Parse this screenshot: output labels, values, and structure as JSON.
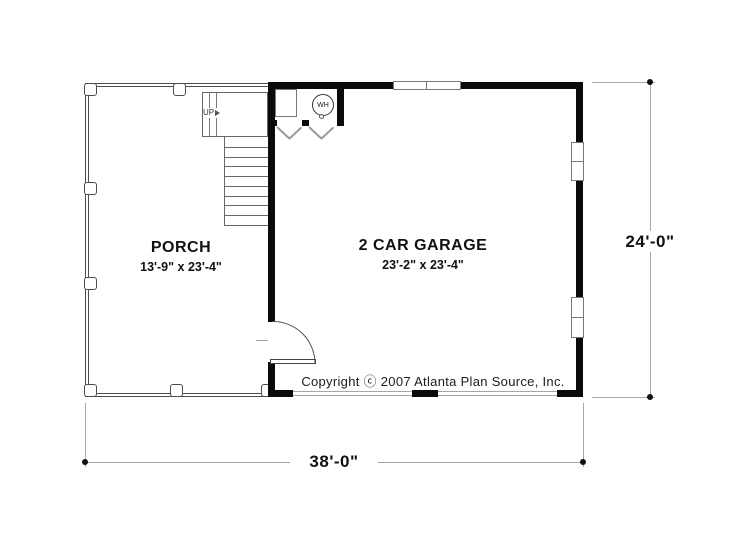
{
  "rooms": [
    {
      "name": "PORCH",
      "size": "13'-9\" x 23'-4\""
    },
    {
      "name": "2 CAR GARAGE",
      "size": "23'-2\" x 23'-4\""
    }
  ],
  "stairs": {
    "up_label": "UP"
  },
  "water_heater": {
    "label": "WH"
  },
  "dimensions": {
    "overall_width": "38'-0\"",
    "overall_height": "24'-0\""
  },
  "copyright": {
    "text": "Copyright ⓒ 2007 Atlanta Plan Source, Inc."
  },
  "colors": {
    "wall": "#0a0a0a",
    "thin_line": "#4d4d4d",
    "dimension_line": "#a6a6a6",
    "text": "#111111"
  }
}
